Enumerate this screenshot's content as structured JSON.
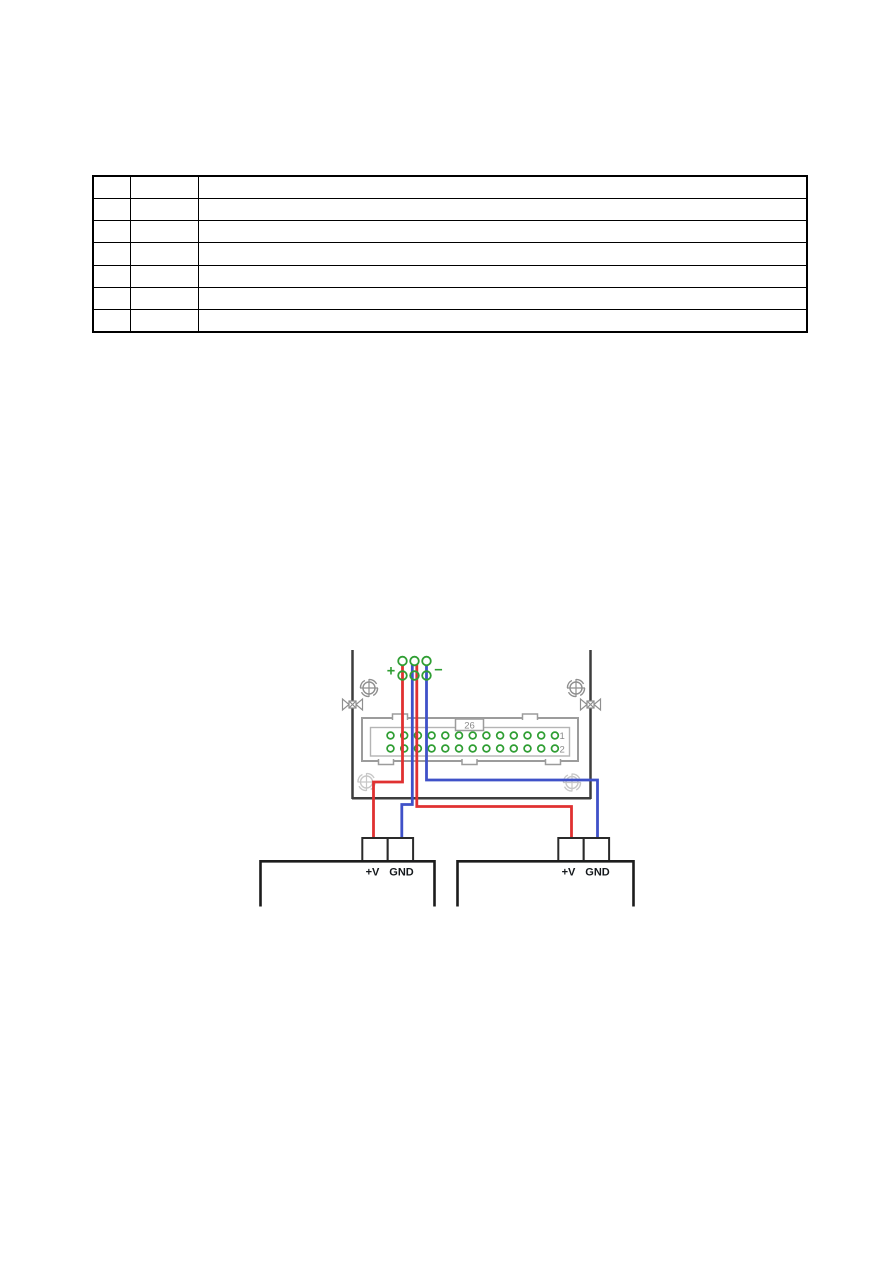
{
  "table": {
    "rows": [
      [
        "",
        "",
        ""
      ],
      [
        "",
        "",
        ""
      ],
      [
        "",
        "",
        ""
      ],
      [
        "",
        "",
        ""
      ],
      [
        "",
        "",
        ""
      ],
      [
        "",
        "",
        ""
      ],
      [
        "",
        "",
        ""
      ]
    ]
  },
  "diagram": {
    "terminal_block": {
      "plus_label": "+",
      "minus_label": "−"
    },
    "connector": {
      "label": "26",
      "pin_rows": 2,
      "pins_per_row": 13,
      "row_labels": [
        "1",
        "2"
      ]
    },
    "power_supplies": [
      {
        "plus_label": "+V",
        "gnd_label": "GND"
      },
      {
        "plus_label": "+V",
        "gnd_label": "GND"
      }
    ],
    "colors": {
      "wire_positive": "#e03131",
      "wire_ground": "#3f51c8",
      "terminal_green": "#2f9e33",
      "board_outline": "#3d3d3d",
      "connector_gray": "#9c9c9c",
      "connector_inner_gray": "#b4b4b4",
      "screw_gray": "#8f8f8f",
      "screw_faded": "#c8c8c8",
      "box_black": "#1c1c1c"
    }
  }
}
